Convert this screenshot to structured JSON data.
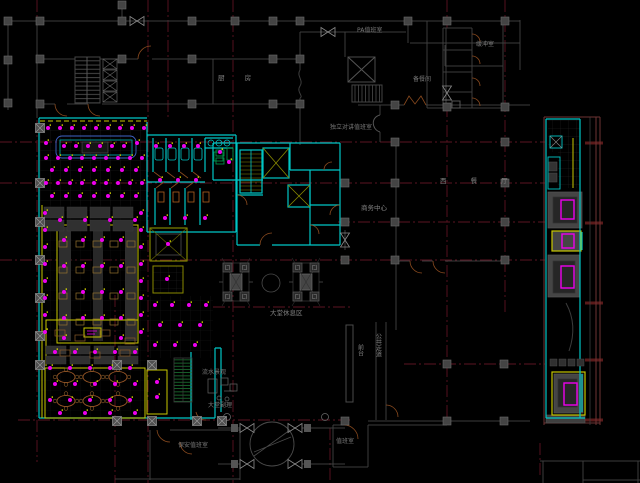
{
  "palette": {
    "background": "#000000",
    "grid_red": "#5c1322",
    "wall_gray": "#3d3d3d",
    "column_gray": "#444444",
    "cyan_wall": "#00c6c6",
    "yellow_ceiling": "#c8c800",
    "olive": "#8a8a00",
    "magenta_light": "#ee00ee",
    "door_brown": "#8a4a1e",
    "table_brown": "#a05a28",
    "stair_green": "#1e8a3a",
    "text_gray": "#828282"
  },
  "labels": {
    "pa_duty_room": "PA值班室",
    "buffer_room": "缓冲室",
    "kitchen": "厨  房",
    "pantry": "备餐间",
    "intercom_duty_room": "独立对讲值班室",
    "business_center": "商务中心",
    "western_restaurant": "西 餐 厅",
    "lobby_lounge": "大堂休息区",
    "water_feature": "流水景观",
    "lobby_manager": "大堂副理",
    "security_duty_room": "保安值班室",
    "duty_room": "值班室",
    "front_desk": "前台",
    "public_corridor": "公共走道"
  }
}
